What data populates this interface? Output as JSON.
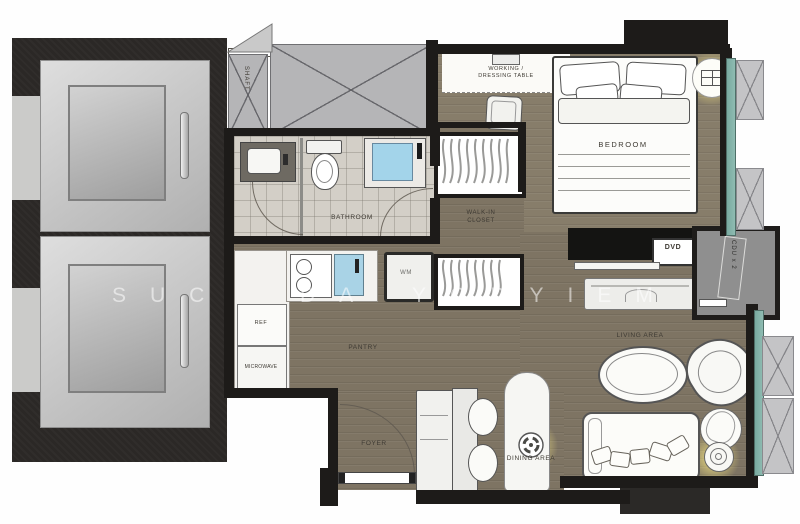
{
  "watermark": {
    "seg1": "SUC",
    "seg2": "DA",
    "seg3": "YODYIEM"
  },
  "rooms": {
    "shaft": "SHAFT",
    "bathroom": "BATHROOM",
    "walk_in_closet_line1": "WALK-IN",
    "walk_in_closet_line2": "CLOSET",
    "bedroom": "BEDROOM",
    "pantry": "PANTRY",
    "foyer": "FOYER",
    "dining_area": "DINING AREA",
    "living_area": "LIVING AREA"
  },
  "furniture": {
    "working_dressing_line1": "WORKING /",
    "working_dressing_line2": "DRESSING TABLE",
    "washing_machine": "WM",
    "refrigerator": "REF",
    "microwave": "MICROWAVE",
    "dvd": "DVD",
    "cdu": "CDU x 2"
  },
  "colors": {
    "wall": "#1d1b19",
    "wood": "#7e7463",
    "wood_light": "#877d6a",
    "tile": "#d3cfc7",
    "hatch": "#b5b5b7",
    "glass": "#8fbcb2",
    "shower": "#a3d4ea",
    "glow": "#f6e682",
    "elevator_block": "#2b2826",
    "cdu_room": "#8f8f8f"
  }
}
